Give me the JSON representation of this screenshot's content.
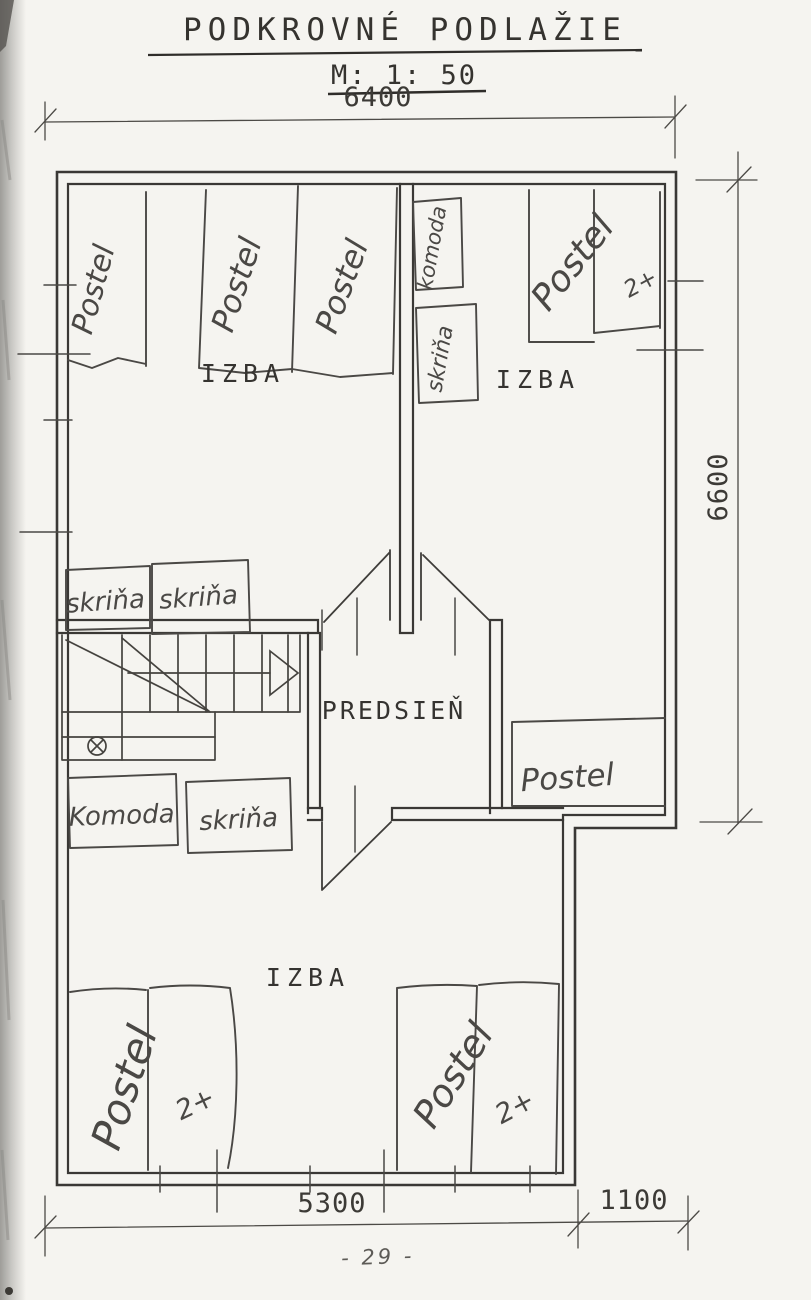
{
  "document": {
    "title": "PODKROVNÉ PODLAŽIE",
    "scale": "M: 1: 50",
    "page_number": "- 29 -"
  },
  "dimensions_mm": {
    "top_width": "6400",
    "right_depth": "6600",
    "bottom_main": "5300",
    "bottom_step": "1100"
  },
  "rooms": {
    "bedroom_top_left": "IZBA",
    "bedroom_top_right": "IZBA",
    "hallway": "PREDSIEŇ",
    "bedroom_bottom": "IZBA"
  },
  "furniture_labels": {
    "bed": "Postel",
    "double_bed_suffix": "2+",
    "wardrobe": "skriňa",
    "dresser": "komoda",
    "dresser_capitalized": "Komoda"
  },
  "colors": {
    "paper": "#f5f4f0",
    "ink": "#35332f",
    "pencil": "#4a4845",
    "wall": "#3a3835"
  }
}
